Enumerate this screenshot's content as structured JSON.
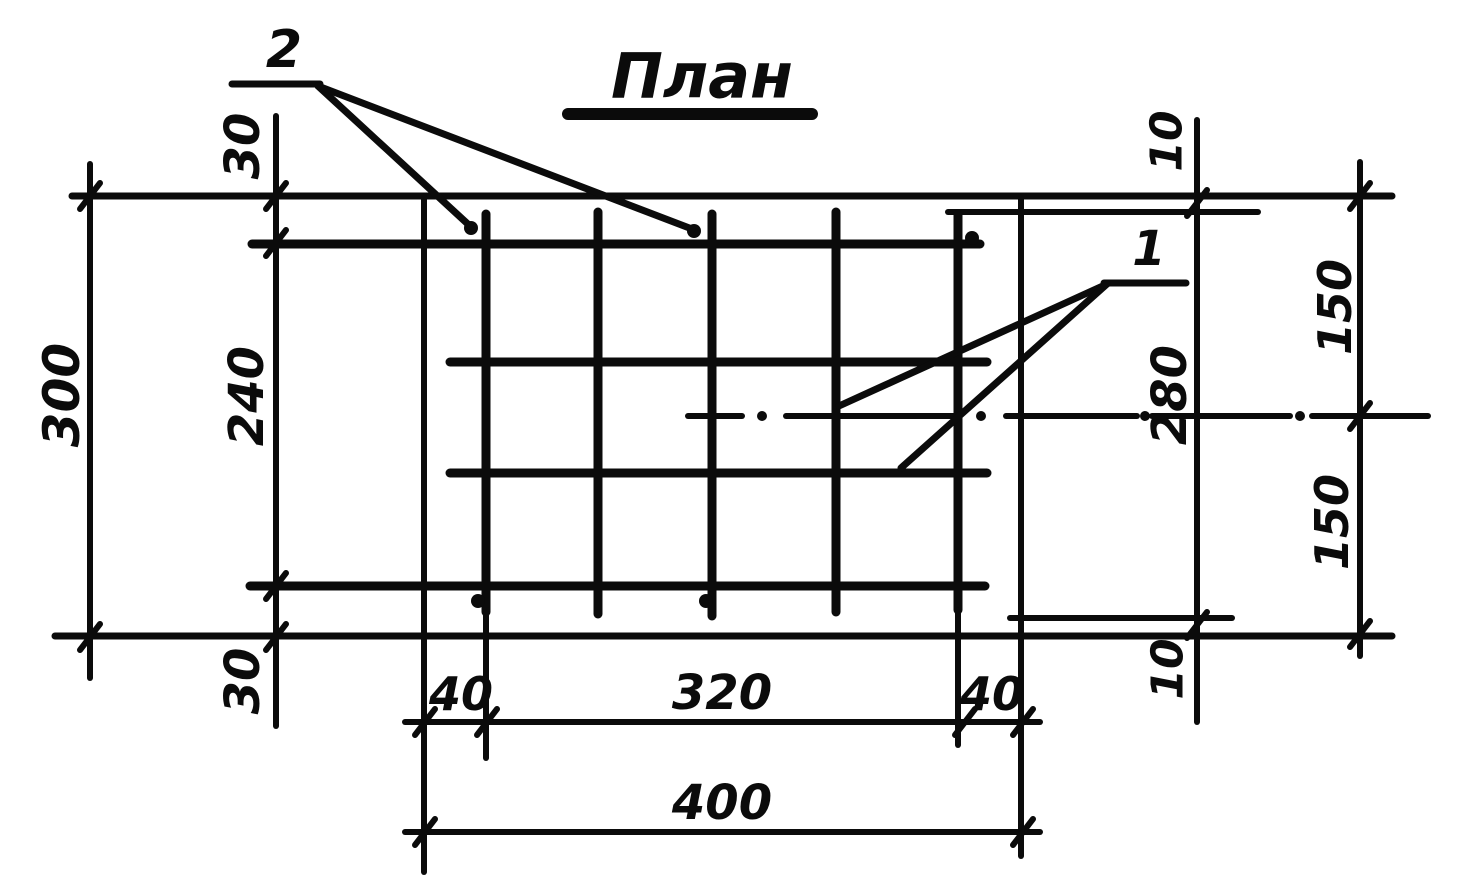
{
  "labels": {
    "title": "План",
    "callout_1": "1",
    "callout_2": "2",
    "dim_300": "300",
    "dim_240": "240",
    "dim_30_top": "30",
    "dim_30_bottom": "30",
    "dim_10_top": "10",
    "dim_280": "280",
    "dim_10_bottom": "10",
    "dim_150_top": "150",
    "dim_150_bottom": "150",
    "dim_40_left": "40",
    "dim_320": "320",
    "dim_40_right": "40",
    "dim_400": "400"
  },
  "drawing": {
    "width": 1457,
    "height": 879,
    "ink": "#0b0b0b",
    "paper": "#ffffff",
    "h_lines": [
      {
        "name": "title-underline",
        "y": 114,
        "x1": 568,
        "x2": 812,
        "t": 12
      },
      {
        "name": "callout-2-underline",
        "y": 84,
        "x1": 232,
        "x2": 320,
        "t": 7
      },
      {
        "name": "slab-top-edge",
        "y": 196,
        "x1": 72,
        "x2": 1392,
        "t": 7
      },
      {
        "name": "mesh-top-extension",
        "y": 212,
        "x1": 948,
        "x2": 1258,
        "t": 6
      },
      {
        "name": "rebar-h1",
        "y": 244,
        "x1": 252,
        "x2": 980,
        "t": 9
      },
      {
        "name": "callout-1-underline",
        "y": 283,
        "x1": 1104,
        "x2": 1186,
        "t": 7
      },
      {
        "name": "rebar-h2",
        "y": 362,
        "x1": 450,
        "x2": 987,
        "t": 9
      },
      {
        "name": "rebar-h3",
        "y": 473,
        "x1": 450,
        "x2": 987,
        "t": 9
      },
      {
        "name": "rebar-h4",
        "y": 586,
        "x1": 250,
        "x2": 985,
        "t": 9
      },
      {
        "name": "mesh-bottom-extension",
        "y": 618,
        "x1": 1010,
        "x2": 1232,
        "t": 6
      },
      {
        "name": "slab-bottom-edge",
        "y": 636,
        "x1": 55,
        "x2": 1392,
        "t": 7
      },
      {
        "name": "dim-line-40-320-40",
        "y": 722,
        "x1": 405,
        "x2": 1040,
        "t": 6
      },
      {
        "name": "dim-line-400",
        "y": 832,
        "x1": 405,
        "x2": 1040,
        "t": 6
      }
    ],
    "v_lines": [
      {
        "name": "dim-line-300",
        "x": 90,
        "y1": 164,
        "y2": 678,
        "t": 6
      },
      {
        "name": "dim-line-240-30",
        "x": 276,
        "y1": 116,
        "y2": 726,
        "t": 6
      },
      {
        "name": "mesh-left-boundary",
        "x": 424,
        "y1": 196,
        "y2": 872,
        "t": 6
      },
      {
        "name": "rebar-v1",
        "x": 486,
        "y1": 214,
        "y2": 612,
        "t": 9
      },
      {
        "name": "rebar-v1-extension",
        "x": 486,
        "y1": 612,
        "y2": 758,
        "t": 6
      },
      {
        "name": "rebar-v2",
        "x": 598,
        "y1": 212,
        "y2": 614,
        "t": 9
      },
      {
        "name": "rebar-v3",
        "x": 712,
        "y1": 214,
        "y2": 616,
        "t": 9
      },
      {
        "name": "rebar-v4",
        "x": 836,
        "y1": 212,
        "y2": 612,
        "t": 9
      },
      {
        "name": "rebar-v5",
        "x": 958,
        "y1": 214,
        "y2": 610,
        "t": 9
      },
      {
        "name": "rebar-v5-extension",
        "x": 958,
        "y1": 610,
        "y2": 745,
        "t": 6
      },
      {
        "name": "mesh-right-boundary",
        "x": 1021,
        "y1": 197,
        "y2": 856,
        "t": 6
      },
      {
        "name": "dim-line-10-280-10",
        "x": 1197,
        "y1": 120,
        "y2": 722,
        "t": 6
      },
      {
        "name": "dim-line-150-150",
        "x": 1360,
        "y1": 162,
        "y2": 656,
        "t": 6
      }
    ],
    "leader_lines": [
      {
        "name": "leader-2a",
        "x1": 318,
        "y1": 86,
        "x2": 470,
        "y2": 226,
        "t": 7
      },
      {
        "name": "leader-2b",
        "x1": 318,
        "y1": 86,
        "x2": 692,
        "y2": 229,
        "t": 7
      },
      {
        "name": "leader-1a",
        "x1": 1107,
        "y1": 284,
        "x2": 839,
        "y2": 406,
        "t": 7
      },
      {
        "name": "leader-1b",
        "x1": 1107,
        "y1": 284,
        "x2": 901,
        "y2": 468,
        "t": 7
      }
    ],
    "centerline": {
      "name": "slab-center-line",
      "y": 416,
      "t": 6,
      "dashes": [
        [
          688,
          742
        ],
        [
          786,
          954
        ],
        [
          1006,
          1137
        ],
        [
          1152,
          1290
        ],
        [
          1312,
          1428
        ]
      ],
      "dots": [
        762,
        981,
        1145,
        1300
      ],
      "dot_r": 5
    },
    "ticks": {
      "t": 6,
      "dx": 10,
      "dy": 13,
      "points": [
        [
          90,
          196
        ],
        [
          90,
          637
        ],
        [
          276,
          196
        ],
        [
          276,
          243
        ],
        [
          276,
          586
        ],
        [
          276,
          637
        ],
        [
          1197,
          203
        ],
        [
          1197,
          625
        ],
        [
          1360,
          196
        ],
        [
          1360,
          416
        ],
        [
          1360,
          634
        ],
        [
          425,
          722
        ],
        [
          487,
          722
        ],
        [
          965,
          722
        ],
        [
          1023,
          722
        ],
        [
          425,
          832
        ],
        [
          1023,
          832
        ]
      ]
    },
    "dots": [
      {
        "name": "rebar-end-dot",
        "x": 471,
        "y": 228,
        "r": 7
      },
      {
        "name": "rebar-end-dot",
        "x": 694,
        "y": 231,
        "r": 7
      },
      {
        "name": "rebar-end-dot",
        "x": 972,
        "y": 238,
        "r": 7
      },
      {
        "name": "rebar-end-dot",
        "x": 478,
        "y": 601,
        "r": 7
      },
      {
        "name": "rebar-end-dot",
        "x": 706,
        "y": 601,
        "r": 7
      }
    ],
    "texts": [
      {
        "name": "drawing-title",
        "bind": "labels.title",
        "x": 702,
        "y": 76,
        "rot": 0,
        "size": 62
      },
      {
        "name": "callout-label-2",
        "bind": "labels.callout_2",
        "x": 284,
        "y": 50,
        "rot": 0,
        "size": 52
      },
      {
        "name": "callout-label-1",
        "bind": "labels.callout_1",
        "x": 1149,
        "y": 249,
        "rot": 0,
        "size": 48
      },
      {
        "name": "dim-label-300",
        "bind": "labels.dim_300",
        "x": 62,
        "y": 395,
        "rot": -90,
        "size": 50
      },
      {
        "name": "dim-label-240",
        "bind": "labels.dim_240",
        "x": 247,
        "y": 396,
        "rot": -90,
        "size": 48
      },
      {
        "name": "dim-label-30-top",
        "bind": "labels.dim_30_top",
        "x": 243,
        "y": 146,
        "rot": -90,
        "size": 48
      },
      {
        "name": "dim-label-30-bottom",
        "bind": "labels.dim_30_bottom",
        "x": 243,
        "y": 681,
        "rot": -90,
        "size": 48
      },
      {
        "name": "dim-label-10-top",
        "bind": "labels.dim_10_top",
        "x": 1167,
        "y": 141,
        "rot": -90,
        "size": 44
      },
      {
        "name": "dim-label-280",
        "bind": "labels.dim_280",
        "x": 1170,
        "y": 395,
        "rot": -90,
        "size": 48
      },
      {
        "name": "dim-label-10-bottom",
        "bind": "labels.dim_10_bottom",
        "x": 1168,
        "y": 669,
        "rot": -90,
        "size": 44
      },
      {
        "name": "dim-label-150-top",
        "bind": "labels.dim_150_top",
        "x": 1335,
        "y": 307,
        "rot": -90,
        "size": 46
      },
      {
        "name": "dim-label-150-bottom",
        "bind": "labels.dim_150_bottom",
        "x": 1332,
        "y": 522,
        "rot": -90,
        "size": 46
      },
      {
        "name": "dim-label-40-left",
        "bind": "labels.dim_40_left",
        "x": 461,
        "y": 694,
        "rot": 0,
        "size": 46
      },
      {
        "name": "dim-label-320",
        "bind": "labels.dim_320",
        "x": 722,
        "y": 693,
        "rot": 0,
        "size": 48
      },
      {
        "name": "dim-label-40-right",
        "bind": "labels.dim_40_right",
        "x": 992,
        "y": 694,
        "rot": 0,
        "size": 46
      },
      {
        "name": "dim-label-400",
        "bind": "labels.dim_400",
        "x": 722,
        "y": 803,
        "rot": 0,
        "size": 48
      }
    ]
  }
}
